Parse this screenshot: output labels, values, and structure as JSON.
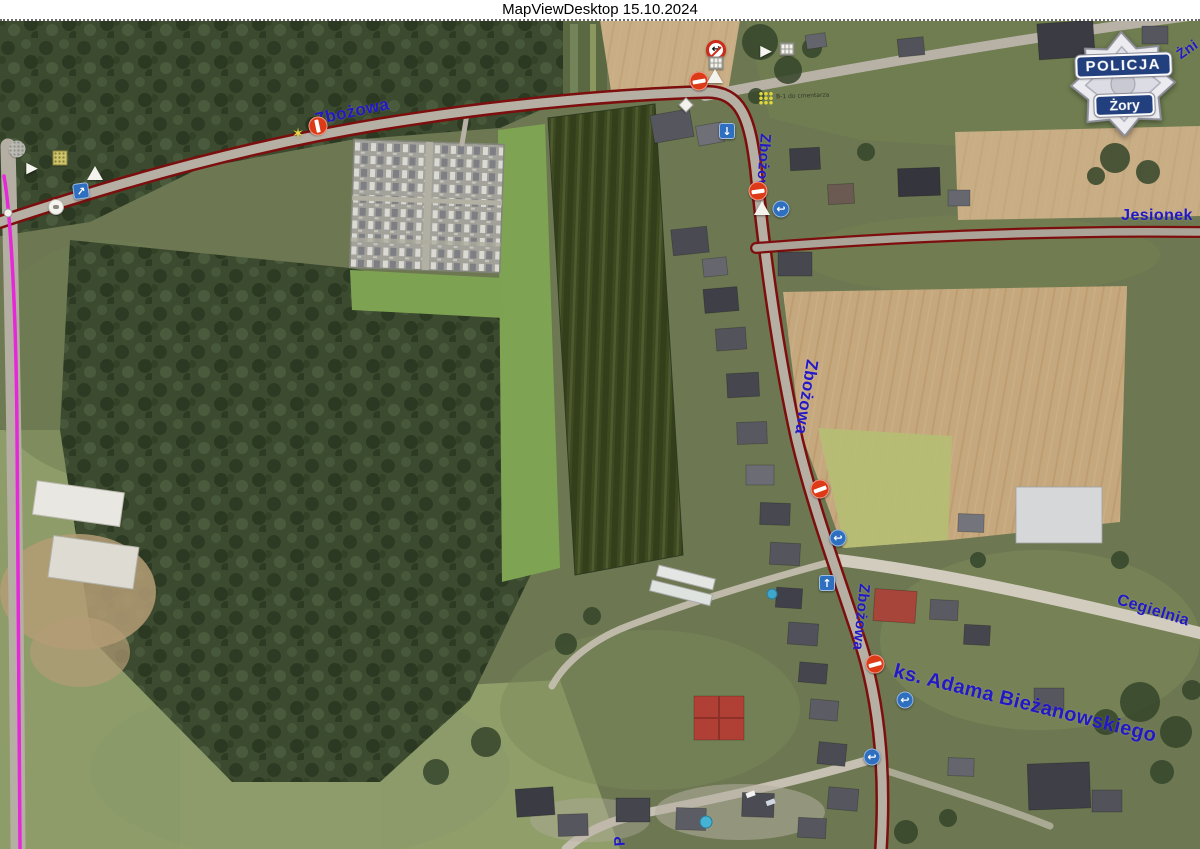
{
  "window": {
    "title": "MapViewDesktop 15.10.2024"
  },
  "badge": {
    "top_banner": "POLICJA",
    "bottom_banner": "Żory"
  },
  "streets": {
    "zbozowa_top": "Zbożowa",
    "zbozowa_north": "Zbożowa",
    "zbozowa_mid": "Zbożowa",
    "zbozowa_south": "Zbożowa",
    "jesionek": "Jesionek",
    "zniwna_partial": "Żni",
    "cegielnia": "Cegielnia",
    "adama_biezanowskiego": "ks. Adama Bieżanowskiego",
    "bottom_partial": "P"
  },
  "annotations": {
    "cemetery_note": "B-1 do cmentarza"
  },
  "icons": {
    "no_entry": "no-entry-icon",
    "no_left_turn": "no-left-turn-icon",
    "yield": "yield-triangle-icon",
    "priority_diamond": "diamond-icon",
    "turn_back_glyph": "↩",
    "down_arrow_glyph": "↓",
    "up_arrow_glyph": "↑",
    "diagonal_arrow_glyph": "↗",
    "play_glyph": "▶",
    "star_glyph": "✶"
  },
  "colors": {
    "street_label": "#2318c6",
    "road_edge_red": "#7d0e0e",
    "route_magenta": "#e528d8",
    "badge_blue": "#23407e",
    "marker_blue": "#2f6fc0",
    "no_entry_red": "#dd3a18"
  }
}
